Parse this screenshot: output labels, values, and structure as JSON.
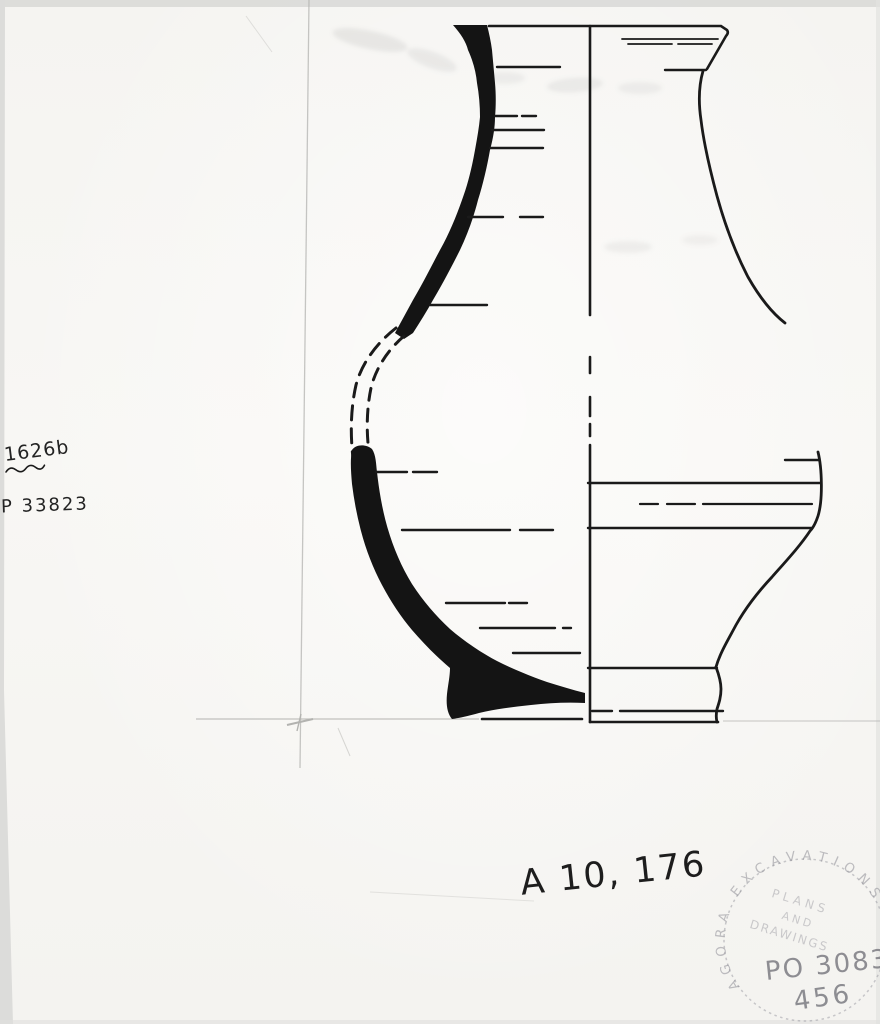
{
  "annotations": {
    "sherd_number": "1626b",
    "inventory_number": "P 33823",
    "caption": "A 10, 176"
  },
  "stamp": {
    "ring_text": "AGORA EXCAVATIONS",
    "center_line1": "PLANS",
    "center_line2": "AND",
    "center_line3": "DRAWINGS",
    "plan_number": "PO 3083-",
    "sheet_number": "456"
  },
  "colors": {
    "paper": "#f6f5f2",
    "ink": "#1a1a1a",
    "pencil": "#b3b3b0",
    "stamp_gray": "#8e8e96"
  }
}
